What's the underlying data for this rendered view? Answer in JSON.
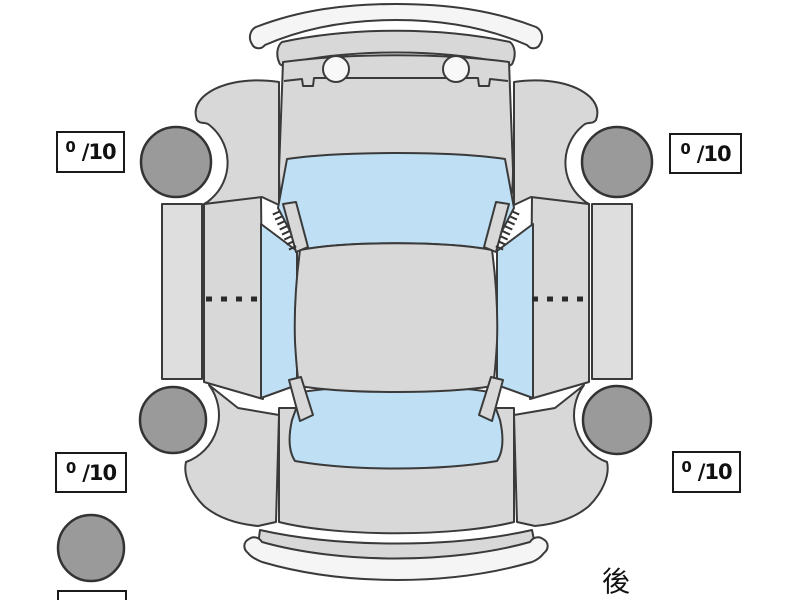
{
  "diagram": {
    "type": "car-top-view-tire-condition-diagram",
    "rear_label": "後",
    "tire_scores": [
      {
        "position": "front-left",
        "value": "0",
        "max": "/10"
      },
      {
        "position": "front-right",
        "value": "0",
        "max": "/10"
      },
      {
        "position": "rear-left",
        "value": "0",
        "max": "/10"
      },
      {
        "position": "rear-right",
        "value": "0",
        "max": "/10"
      }
    ],
    "spare_tire": {
      "shown": true,
      "score_box": "partially cut off at bottom edge"
    },
    "colors": {
      "background": "#ffffff",
      "body_gray": "#d8d8d8",
      "panel_gray": "#dedede",
      "glass_blue": "#bfe0f4",
      "tire_gray": "#9a9a9a",
      "bumper_light": "#f5f5f5",
      "outline": "#3a3a3a",
      "box_border": "#1a1a1a"
    }
  }
}
